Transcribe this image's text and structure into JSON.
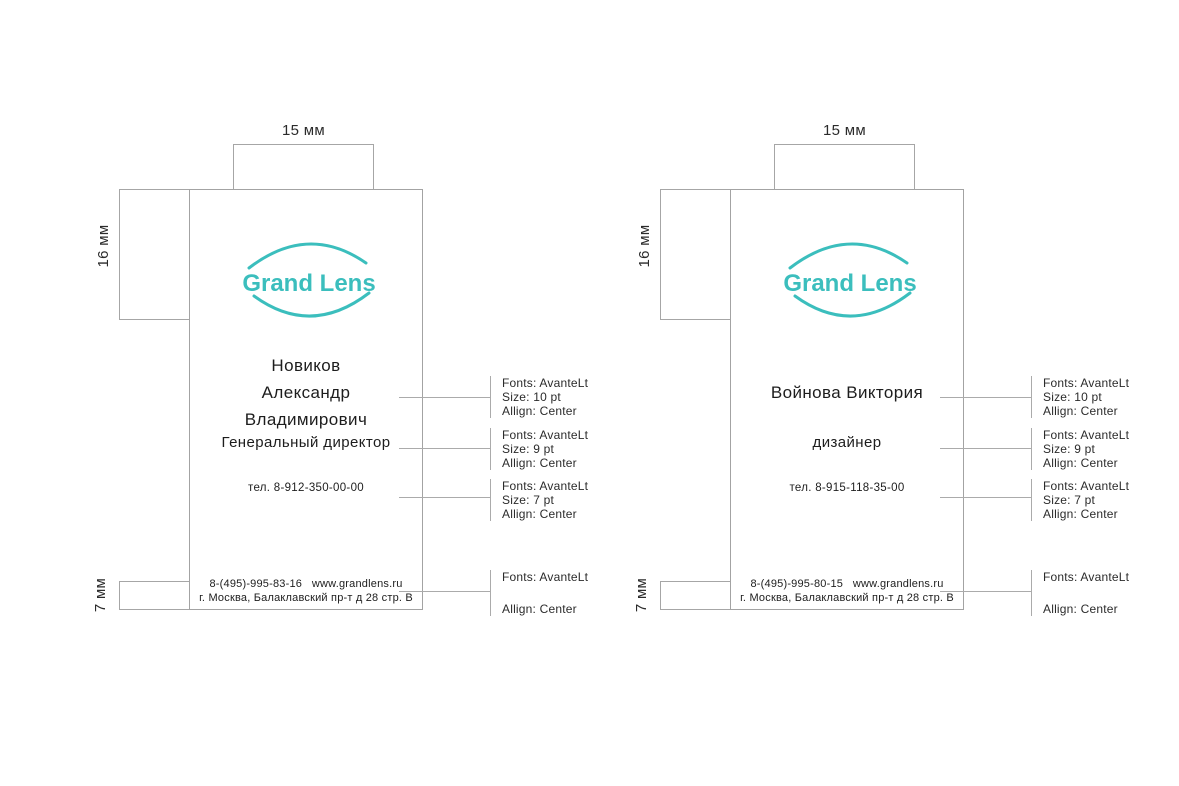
{
  "colors": {
    "accent": "#3bbebd",
    "construction_line": "#a6a6a6",
    "text": "#1d1d1d"
  },
  "dimensions": {
    "logo_offset_top": "15 мм",
    "logo_offset_left": "16 мм",
    "footer_height": "7 мм"
  },
  "brand": {
    "logo_text": "Grand Lens"
  },
  "cards": [
    {
      "logo_text": "Grand Lens",
      "name": "Новиков\nАлександр\nВладимирович",
      "title": "Генеральный директор",
      "phone": "тел. 8-912-350-00-00",
      "footer": "8-(495)-995-83-16   www.grandlens.ru\nг. Москва, Балаклавский пр-т д 28 стр. В",
      "dim_top": "15 мм",
      "dim_left": "16 мм",
      "dim_bottom": "7 мм",
      "annotations": [
        {
          "font": "Fonts: AvanteLt",
          "size": "Size: 10 pt",
          "align": "Allign: Center"
        },
        {
          "font": "Fonts: AvanteLt",
          "size": "Size: 9 pt",
          "align": "Allign: Center"
        },
        {
          "font": "Fonts: AvanteLt",
          "size": "Size: 7 pt",
          "align": "Allign: Center"
        },
        {
          "font": "Fonts: AvanteLt",
          "align": "Allign: Center"
        }
      ]
    },
    {
      "logo_text": "Grand Lens",
      "name": "Войнова Виктория",
      "title": "дизайнер",
      "phone": "тел. 8-915-118-35-00",
      "footer": "8-(495)-995-80-15   www.grandlens.ru\nг. Москва, Балаклавский пр-т д 28 стр. В",
      "dim_top": "15 мм",
      "dim_left": "16 мм",
      "dim_bottom": "7 мм",
      "annotations": [
        {
          "font": "Fonts: AvanteLt",
          "size": "Size: 10 pt",
          "align": "Allign: Center"
        },
        {
          "font": "Fonts: AvanteLt",
          "size": "Size: 9 pt",
          "align": "Allign: Center"
        },
        {
          "font": "Fonts: AvanteLt",
          "size": "Size: 7 pt",
          "align": "Allign: Center"
        },
        {
          "font": "Fonts: AvanteLt",
          "align": "Allign: Center"
        }
      ]
    }
  ]
}
